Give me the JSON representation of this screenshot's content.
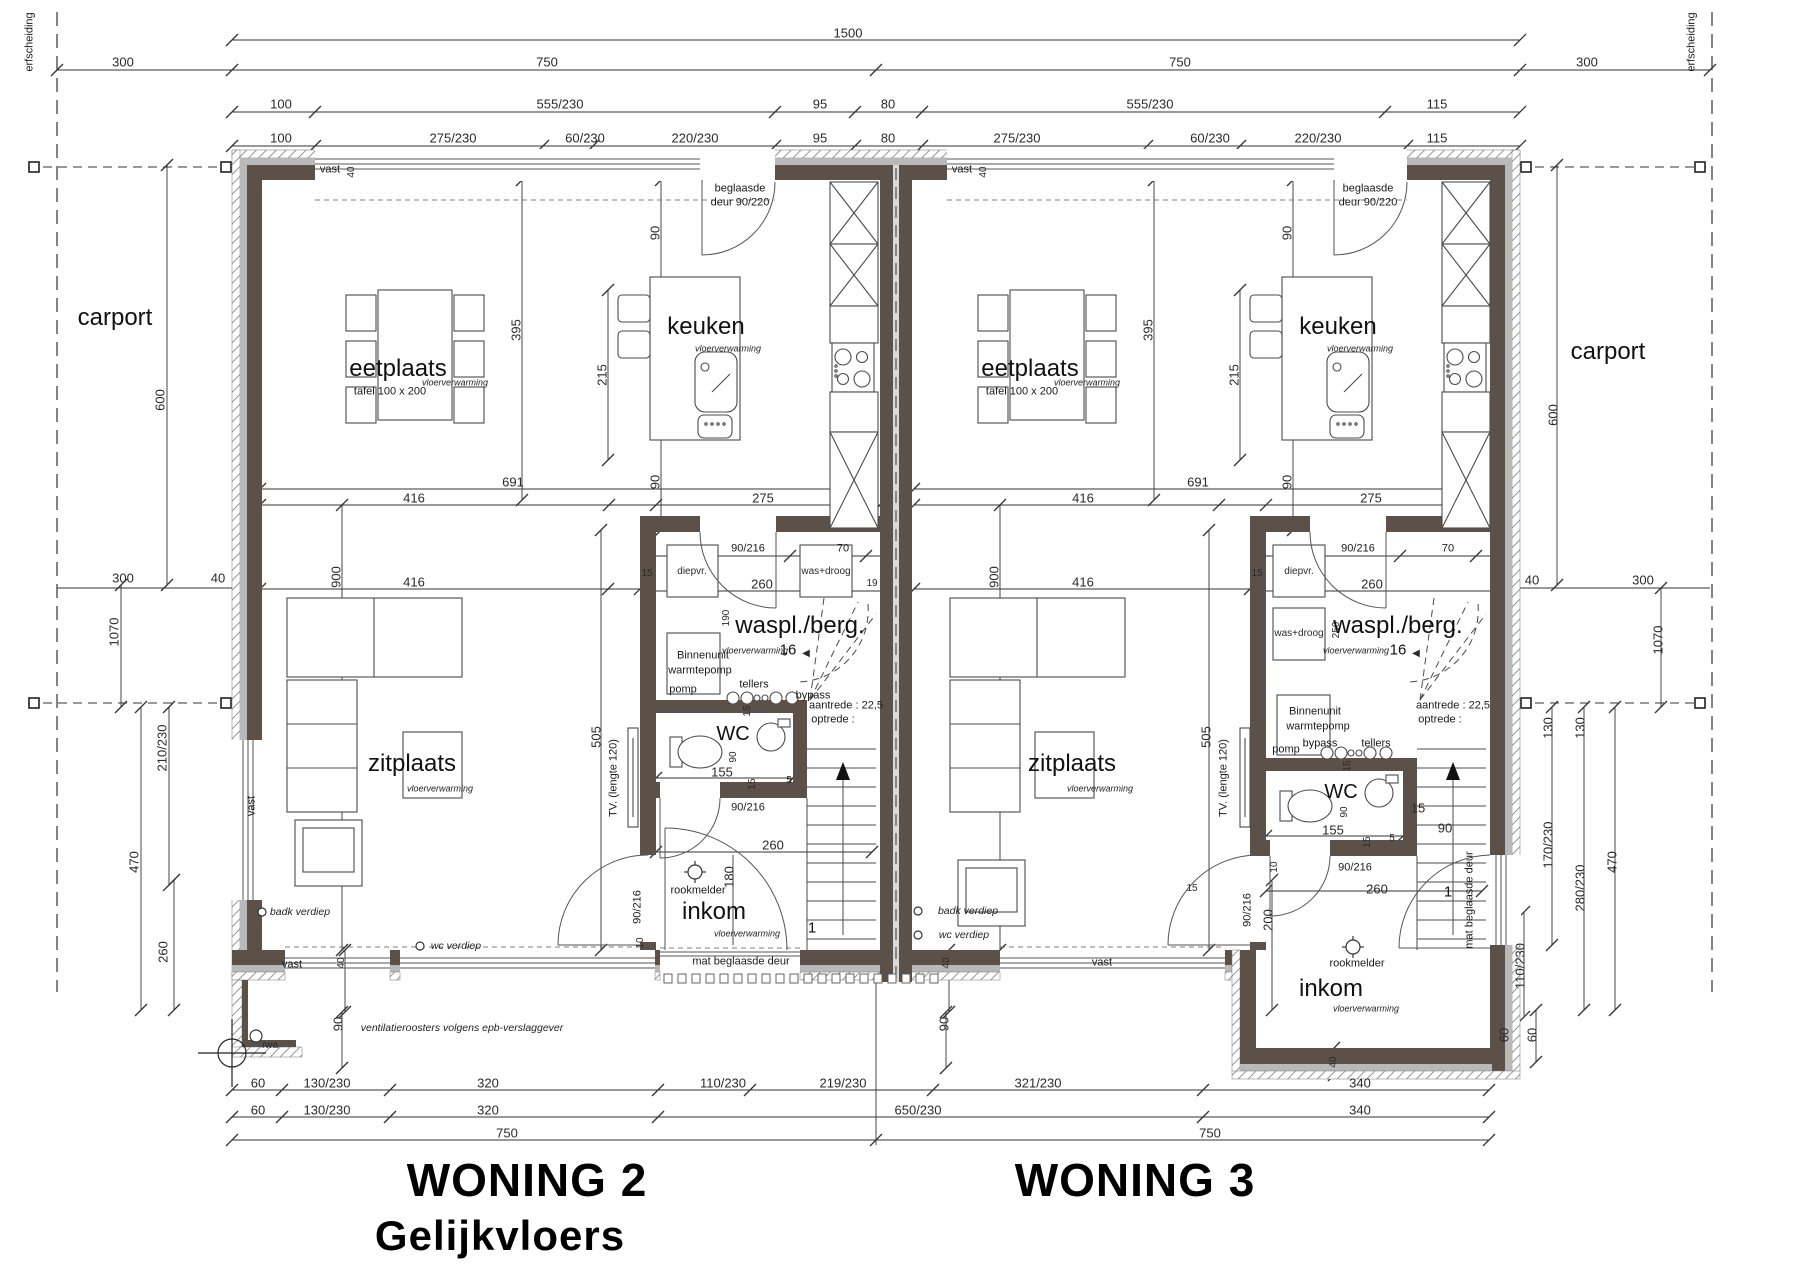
{
  "titles": {
    "woning2": "WONING 2",
    "woning2_sub": "Gelijkvloers",
    "woning3": "WONING 3"
  },
  "colors": {
    "wall": "#5b5149",
    "wall_gray": "#b9b9b9",
    "line": "#333333",
    "hatch": "#8a8a8a"
  },
  "labels": [
    {
      "t": "1500",
      "x": 848,
      "y": 33
    },
    {
      "t": "300",
      "x": 123,
      "y": 62
    },
    {
      "t": "750",
      "x": 547,
      "y": 62
    },
    {
      "t": "750",
      "x": 1180,
      "y": 62
    },
    {
      "t": "300",
      "x": 1587,
      "y": 62
    },
    {
      "t": "100",
      "x": 281,
      "y": 104
    },
    {
      "t": "555/230",
      "x": 560,
      "y": 104
    },
    {
      "t": "95",
      "x": 820,
      "y": 104
    },
    {
      "t": "80",
      "x": 888,
      "y": 104
    },
    {
      "t": "555/230",
      "x": 1150,
      "y": 104
    },
    {
      "t": "115",
      "x": 1437,
      "y": 104
    },
    {
      "t": "100",
      "x": 281,
      "y": 138
    },
    {
      "t": "275/230",
      "x": 453,
      "y": 138
    },
    {
      "t": "60/230",
      "x": 585,
      "y": 138
    },
    {
      "t": "220/230",
      "x": 695,
      "y": 138
    },
    {
      "t": "95",
      "x": 820,
      "y": 138
    },
    {
      "t": "80",
      "x": 888,
      "y": 138
    },
    {
      "t": "275/230",
      "x": 1017,
      "y": 138
    },
    {
      "t": "60/230",
      "x": 1210,
      "y": 138
    },
    {
      "t": "220/230",
      "x": 1318,
      "y": 138
    },
    {
      "t": "115",
      "x": 1437,
      "y": 138
    },
    {
      "t": "erfscheiding",
      "x": 30,
      "y": 42,
      "r": 1,
      "c": "note",
      "n": "erfscheiding-label-left"
    },
    {
      "t": "erfscheiding",
      "x": 1692,
      "y": 42,
      "r": 1,
      "c": "note",
      "n": "erfscheiding-label-right"
    },
    {
      "t": "carport",
      "x": 115,
      "y": 318,
      "c": "room",
      "n": "room-carport-left"
    },
    {
      "t": "carport",
      "x": 1608,
      "y": 352,
      "c": "room",
      "n": "room-carport-right"
    },
    {
      "t": "600",
      "x": 160,
      "y": 400,
      "r": 1
    },
    {
      "t": "300",
      "x": 123,
      "y": 578
    },
    {
      "t": "40",
      "x": 218,
      "y": 578
    },
    {
      "t": "1070",
      "x": 114,
      "y": 632,
      "r": 1
    },
    {
      "t": "210/230",
      "x": 162,
      "y": 748,
      "r": 1
    },
    {
      "t": "470",
      "x": 134,
      "y": 862,
      "r": 1
    },
    {
      "t": "260",
      "x": 163,
      "y": 952,
      "r": 1
    },
    {
      "t": "600",
      "x": 1553,
      "y": 415,
      "r": 1
    },
    {
      "t": "40",
      "x": 1532,
      "y": 580
    },
    {
      "t": "300",
      "x": 1643,
      "y": 580
    },
    {
      "t": "1070",
      "x": 1658,
      "y": 640,
      "r": 1
    },
    {
      "t": "130",
      "x": 1548,
      "y": 728,
      "r": 1
    },
    {
      "t": "130",
      "x": 1580,
      "y": 728,
      "r": 1
    },
    {
      "t": "170/230",
      "x": 1548,
      "y": 845,
      "r": 1
    },
    {
      "t": "280/230",
      "x": 1580,
      "y": 888,
      "r": 1
    },
    {
      "t": "470",
      "x": 1612,
      "y": 862,
      "r": 1
    },
    {
      "t": "110/230",
      "x": 1520,
      "y": 966,
      "r": 1
    },
    {
      "t": "60",
      "x": 1504,
      "y": 1035,
      "r": 1
    },
    {
      "t": "60",
      "x": 1532,
      "y": 1035,
      "r": 1
    },
    {
      "t": "vast",
      "x": 330,
      "y": 170,
      "c": "note"
    },
    {
      "t": "40",
      "x": 352,
      "y": 172,
      "r": 1,
      "c": "tiny"
    },
    {
      "t": "beglaasde",
      "x": 740,
      "y": 189,
      "c": "note"
    },
    {
      "t": "deur 90/220",
      "x": 740,
      "y": 203,
      "c": "note"
    },
    {
      "t": "vast",
      "x": 962,
      "y": 170,
      "c": "note"
    },
    {
      "t": "40",
      "x": 984,
      "y": 172,
      "r": 1,
      "c": "tiny"
    },
    {
      "t": "beglaasde",
      "x": 1368,
      "y": 189,
      "c": "note"
    },
    {
      "t": "deur 90/220",
      "x": 1368,
      "y": 203,
      "c": "note"
    },
    {
      "t": "eetplaats",
      "x": 398,
      "y": 369,
      "c": "room",
      "n": "room-eetplaats-w2"
    },
    {
      "t": "tafel 100 x 200",
      "x": 390,
      "y": 392,
      "c": "note"
    },
    {
      "t": "vloerverwarming",
      "x": 455,
      "y": 383,
      "c": "it"
    },
    {
      "t": "keuken",
      "x": 706,
      "y": 327,
      "c": "room",
      "n": "room-keuken-w2"
    },
    {
      "t": "vloerverwarming",
      "x": 728,
      "y": 349,
      "c": "it"
    },
    {
      "t": "395",
      "x": 516,
      "y": 330,
      "r": 1
    },
    {
      "t": "215",
      "x": 602,
      "y": 375,
      "r": 1
    },
    {
      "t": "90",
      "x": 655,
      "y": 233,
      "r": 1
    },
    {
      "t": "691",
      "x": 513,
      "y": 482
    },
    {
      "t": "416",
      "x": 414,
      "y": 498
    },
    {
      "t": "275",
      "x": 763,
      "y": 498
    },
    {
      "t": "90",
      "x": 655,
      "y": 482,
      "r": 1
    },
    {
      "t": "416",
      "x": 414,
      "y": 582
    },
    {
      "t": "900",
      "x": 336,
      "y": 577,
      "r": 1
    },
    {
      "t": "15",
      "x": 647,
      "y": 574,
      "c": "tiny"
    },
    {
      "t": "19",
      "x": 872,
      "y": 584,
      "c": "tiny"
    },
    {
      "t": "90/216",
      "x": 748,
      "y": 549,
      "c": "note"
    },
    {
      "t": "70",
      "x": 843,
      "y": 549,
      "c": "note"
    },
    {
      "t": "260",
      "x": 762,
      "y": 584
    },
    {
      "t": "190",
      "x": 727,
      "y": 618,
      "r": 1,
      "c": "tiny"
    },
    {
      "t": "diepvr.",
      "x": 692,
      "y": 572,
      "c": "tiny"
    },
    {
      "t": "was+droog",
      "x": 826,
      "y": 572,
      "c": "tiny"
    },
    {
      "t": "waspl./berg.",
      "x": 800,
      "y": 626,
      "c": "room",
      "n": "room-waspl-w2"
    },
    {
      "t": "vloerverwarming",
      "x": 755,
      "y": 651,
      "c": "it"
    },
    {
      "t": "16",
      "x": 788,
      "y": 650,
      "c": "note16"
    },
    {
      "t": "◀",
      "x": 806,
      "y": 654,
      "c": "tiny"
    },
    {
      "t": "Binnenunit",
      "x": 703,
      "y": 656,
      "c": "note"
    },
    {
      "t": "warmtepomp",
      "x": 700,
      "y": 671,
      "c": "note"
    },
    {
      "t": "pomp",
      "x": 683,
      "y": 690,
      "c": "note"
    },
    {
      "t": "tellers",
      "x": 754,
      "y": 685,
      "c": "note"
    },
    {
      "t": "bypass",
      "x": 813,
      "y": 696,
      "c": "note"
    },
    {
      "t": "aantrede : 22,5",
      "x": 846,
      "y": 706,
      "c": "note"
    },
    {
      "t": "optrede  :",
      "x": 833,
      "y": 720,
      "c": "note"
    },
    {
      "t": "15",
      "x": 748,
      "y": 711,
      "r": 1,
      "c": "tiny"
    },
    {
      "t": "WC",
      "x": 733,
      "y": 734,
      "c": "roomsm",
      "n": "room-wc-w2"
    },
    {
      "t": "90",
      "x": 734,
      "y": 757,
      "r": 1,
      "c": "tiny"
    },
    {
      "t": "155",
      "x": 722,
      "y": 772
    },
    {
      "t": "15",
      "x": 753,
      "y": 784,
      "r": 1,
      "c": "tiny"
    },
    {
      "t": "5",
      "x": 789,
      "y": 781,
      "c": "tiny"
    },
    {
      "t": "90/216",
      "x": 748,
      "y": 808,
      "c": "note"
    },
    {
      "t": "260",
      "x": 773,
      "y": 845
    },
    {
      "t": "180",
      "x": 729,
      "y": 877,
      "r": 1
    },
    {
      "t": "rookmelder",
      "x": 698,
      "y": 891,
      "c": "note"
    },
    {
      "t": "inkom",
      "x": 714,
      "y": 912,
      "c": "room",
      "n": "room-inkom-w2"
    },
    {
      "t": "vloerverwarming",
      "x": 747,
      "y": 934,
      "c": "it"
    },
    {
      "t": "mat beglaasde deur",
      "x": 741,
      "y": 962,
      "c": "note"
    },
    {
      "t": "1",
      "x": 812,
      "y": 928,
      "c": "note16"
    },
    {
      "t": "90/216",
      "x": 638,
      "y": 907,
      "r": 1,
      "c": "note"
    },
    {
      "t": "10",
      "x": 641,
      "y": 943,
      "r": 1,
      "c": "tiny"
    },
    {
      "t": "TV. (lengte 120)",
      "x": 614,
      "y": 778,
      "r": 1,
      "c": "note"
    },
    {
      "t": "505",
      "x": 596,
      "y": 737,
      "r": 1
    },
    {
      "t": "zitplaats",
      "x": 412,
      "y": 764,
      "c": "room",
      "n": "room-zitplaats-w2"
    },
    {
      "t": "vloerverwarming",
      "x": 440,
      "y": 789,
      "c": "it"
    },
    {
      "t": "vast",
      "x": 252,
      "y": 806,
      "r": 1,
      "c": "note"
    },
    {
      "t": "badk verdiep",
      "x": 300,
      "y": 912,
      "c": "it11"
    },
    {
      "t": "wc verdiep",
      "x": 456,
      "y": 946,
      "c": "it11"
    },
    {
      "t": "badk verdiep",
      "x": 968,
      "y": 911,
      "c": "it11"
    },
    {
      "t": "wc verdiep",
      "x": 964,
      "y": 935,
      "c": "it11"
    },
    {
      "t": "rwa",
      "x": 270,
      "y": 1046,
      "c": "tiny"
    },
    {
      "t": "ventilatieroosters volgens epb-verslaggever",
      "x": 462,
      "y": 1028,
      "c": "it11"
    },
    {
      "t": "vast",
      "x": 292,
      "y": 965,
      "c": "note"
    },
    {
      "t": "40",
      "x": 342,
      "y": 963,
      "r": 1,
      "c": "tiny"
    },
    {
      "t": "90",
      "x": 338,
      "y": 1024,
      "r": 1
    },
    {
      "t": "60",
      "x": 258,
      "y": 1083
    },
    {
      "t": "130/230",
      "x": 327,
      "y": 1083
    },
    {
      "t": "320",
      "x": 488,
      "y": 1083
    },
    {
      "t": "110/230",
      "x": 723,
      "y": 1083
    },
    {
      "t": "219/230",
      "x": 843,
      "y": 1083
    },
    {
      "t": "321/230",
      "x": 1038,
      "y": 1083
    },
    {
      "t": "340",
      "x": 1360,
      "y": 1083
    },
    {
      "t": "60",
      "x": 258,
      "y": 1110
    },
    {
      "t": "130/230",
      "x": 327,
      "y": 1110
    },
    {
      "t": "320",
      "x": 488,
      "y": 1110
    },
    {
      "t": "650/230",
      "x": 918,
      "y": 1110
    },
    {
      "t": "340",
      "x": 1360,
      "y": 1110
    },
    {
      "t": "750",
      "x": 507,
      "y": 1133
    },
    {
      "t": "750",
      "x": 1210,
      "y": 1133
    },
    {
      "t": "eetplaats",
      "x": 1030,
      "y": 369,
      "c": "room",
      "n": "room-eetplaats-w3"
    },
    {
      "t": "tafel 100 x 200",
      "x": 1022,
      "y": 392,
      "c": "note"
    },
    {
      "t": "vloerverwarming",
      "x": 1087,
      "y": 383,
      "c": "it"
    },
    {
      "t": "keuken",
      "x": 1338,
      "y": 327,
      "c": "room",
      "n": "room-keuken-w3"
    },
    {
      "t": "vloerverwarming",
      "x": 1360,
      "y": 349,
      "c": "it"
    },
    {
      "t": "395",
      "x": 1148,
      "y": 330,
      "r": 1
    },
    {
      "t": "215",
      "x": 1234,
      "y": 375,
      "r": 1
    },
    {
      "t": "90",
      "x": 1287,
      "y": 233,
      "r": 1
    },
    {
      "t": "691",
      "x": 1198,
      "y": 482
    },
    {
      "t": "416",
      "x": 1083,
      "y": 498
    },
    {
      "t": "275",
      "x": 1371,
      "y": 498
    },
    {
      "t": "90",
      "x": 1287,
      "y": 482,
      "r": 1
    },
    {
      "t": "416",
      "x": 1083,
      "y": 582
    },
    {
      "t": "900",
      "x": 994,
      "y": 577,
      "r": 1
    },
    {
      "t": "15",
      "x": 1257,
      "y": 574,
      "c": "tiny"
    },
    {
      "t": "90/216",
      "x": 1358,
      "y": 549,
      "c": "note"
    },
    {
      "t": "70",
      "x": 1448,
      "y": 549,
      "c": "note"
    },
    {
      "t": "260",
      "x": 1372,
      "y": 584
    },
    {
      "t": "250",
      "x": 1337,
      "y": 630,
      "r": 1,
      "c": "tiny"
    },
    {
      "t": "diepvr.",
      "x": 1299,
      "y": 572,
      "c": "tiny"
    },
    {
      "t": "was+droog",
      "x": 1299,
      "y": 634,
      "c": "tiny"
    },
    {
      "t": "waspl./berg.",
      "x": 1398,
      "y": 626,
      "c": "room",
      "n": "room-waspl-w3"
    },
    {
      "t": "vloerverwarming",
      "x": 1356,
      "y": 651,
      "c": "it"
    },
    {
      "t": "16",
      "x": 1398,
      "y": 650,
      "c": "note16"
    },
    {
      "t": "◀",
      "x": 1416,
      "y": 654,
      "c": "tiny"
    },
    {
      "t": "Binnenunit",
      "x": 1315,
      "y": 712,
      "c": "note"
    },
    {
      "t": "warmtepomp",
      "x": 1318,
      "y": 727,
      "c": "note"
    },
    {
      "t": "pomp",
      "x": 1286,
      "y": 750,
      "c": "note"
    },
    {
      "t": "tellers",
      "x": 1376,
      "y": 744,
      "c": "note"
    },
    {
      "t": "bypass",
      "x": 1320,
      "y": 744,
      "c": "note"
    },
    {
      "t": "aantrede : 22,5",
      "x": 1453,
      "y": 706,
      "c": "note"
    },
    {
      "t": "optrede  :",
      "x": 1440,
      "y": 720,
      "c": "note"
    },
    {
      "t": "WC",
      "x": 1341,
      "y": 792,
      "c": "roomsm",
      "n": "room-wc-w3"
    },
    {
      "t": "90",
      "x": 1345,
      "y": 812,
      "r": 1,
      "c": "tiny"
    },
    {
      "t": "155",
      "x": 1333,
      "y": 830
    },
    {
      "t": "15",
      "x": 1348,
      "y": 766,
      "r": 1,
      "c": "tiny"
    },
    {
      "t": "15",
      "x": 1368,
      "y": 842,
      "r": 1,
      "c": "tiny"
    },
    {
      "t": "5",
      "x": 1392,
      "y": 839,
      "c": "tiny"
    },
    {
      "t": "90/216",
      "x": 1355,
      "y": 868,
      "c": "note"
    },
    {
      "t": "260",
      "x": 1377,
      "y": 889
    },
    {
      "t": "200",
      "x": 1268,
      "y": 920,
      "r": 1
    },
    {
      "t": "rookmelder",
      "x": 1357,
      "y": 964,
      "c": "note"
    },
    {
      "t": "inkom",
      "x": 1331,
      "y": 989,
      "c": "room",
      "n": "room-inkom-w3"
    },
    {
      "t": "vloerverwarming",
      "x": 1366,
      "y": 1009,
      "c": "it"
    },
    {
      "t": "1",
      "x": 1448,
      "y": 892,
      "c": "note16"
    },
    {
      "t": "mat beglaasde deur",
      "x": 1470,
      "y": 900,
      "r": 1,
      "c": "note"
    },
    {
      "t": "90",
      "x": 1445,
      "y": 828
    },
    {
      "t": "15",
      "x": 1418,
      "y": 808
    },
    {
      "t": "90/216",
      "x": 1248,
      "y": 910,
      "r": 1,
      "c": "note"
    },
    {
      "t": "10",
      "x": 1275,
      "y": 867,
      "r": 1,
      "c": "tiny"
    },
    {
      "t": "15",
      "x": 1192,
      "y": 889,
      "c": "tiny"
    },
    {
      "t": "TV. (lengte 120)",
      "x": 1224,
      "y": 778,
      "r": 1,
      "c": "note"
    },
    {
      "t": "505",
      "x": 1206,
      "y": 737,
      "r": 1
    },
    {
      "t": "zitplaats",
      "x": 1072,
      "y": 764,
      "c": "room",
      "n": "room-zitplaats-w3"
    },
    {
      "t": "vloerverwarming",
      "x": 1100,
      "y": 789,
      "c": "it"
    },
    {
      "t": "vast",
      "x": 1102,
      "y": 963,
      "c": "note"
    },
    {
      "t": "40",
      "x": 947,
      "y": 963,
      "r": 1,
      "c": "tiny"
    },
    {
      "t": "90",
      "x": 944,
      "y": 1024,
      "r": 1
    },
    {
      "t": "40",
      "x": 1334,
      "y": 1062,
      "r": 1,
      "c": "tiny"
    }
  ]
}
